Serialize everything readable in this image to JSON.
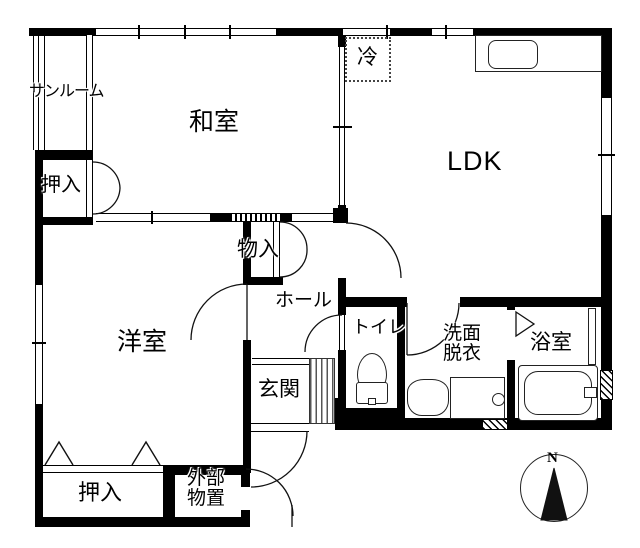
{
  "floorplan": {
    "title_hint": "Japanese apartment floor plan",
    "colors": {
      "wall": "#000000",
      "background": "#ffffff"
    },
    "rooms": {
      "sunroom": "サンルーム",
      "washitsu": "和室",
      "ldk": "LDK",
      "fridge": "冷",
      "oshiire_top": "押入",
      "monoiri": "物入",
      "hall": "ホール",
      "yoshitsu": "洋室",
      "genkan": "玄関",
      "toilet": "トイレ",
      "senmen_line1": "洗面",
      "senmen_line2": "脱衣",
      "bathroom": "浴室",
      "oshiire_bottom": "押入",
      "storage_line1": "外部",
      "storage_line2": "物置"
    },
    "compass": {
      "north_label": "N"
    }
  }
}
